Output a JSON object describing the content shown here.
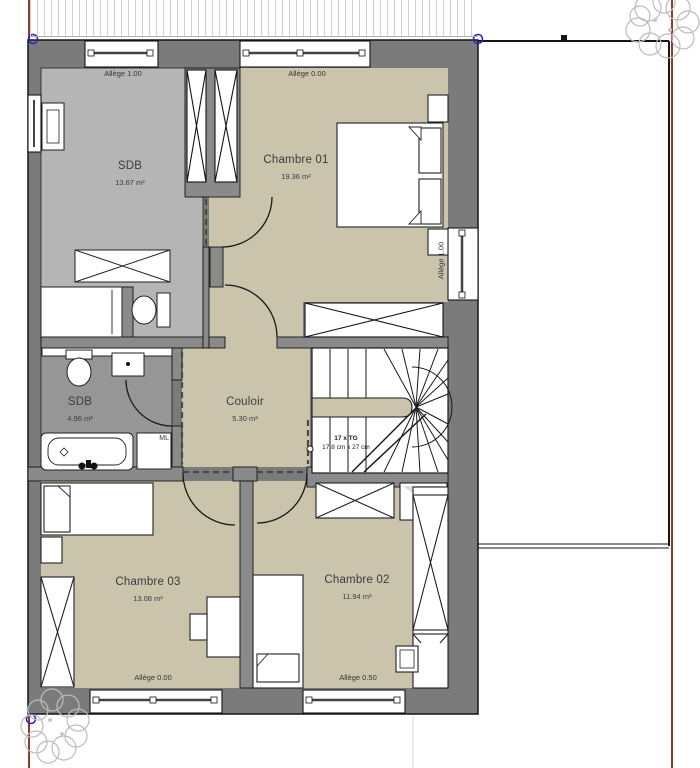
{
  "plan": {
    "rooms": [
      {
        "name": "SDB",
        "area": "13.67 m²"
      },
      {
        "name": "Chambre 01",
        "area": "19.36 m²"
      },
      {
        "name": "SDB",
        "area": "4.96 m²"
      },
      {
        "name": "Couloir",
        "area": "5.30 m²"
      },
      {
        "name": "Chambre 03",
        "area": "13.08 m²"
      },
      {
        "name": "Chambre 02",
        "area": "11.94 m²"
      }
    ],
    "sill_labels": {
      "top_left": "Allège 1.00",
      "top_right": "Allège 0.00",
      "right": "Allège 1.00",
      "bottom_left": "Allège 0.00",
      "bottom_right": "Allège 0.50"
    },
    "stairs": {
      "count_label": "17 x TG",
      "step_label": "17,8 cm x 27 cm"
    },
    "appliances": {
      "washing_machine": "ML"
    },
    "colors": {
      "exterior_wall": "#7b7b7b",
      "interior_wall": "#8a8a8a",
      "floor_bath_large": "#b5b5b5",
      "floor_bath_small": "#969696",
      "floor_rooms": "#cbc4ad",
      "boundary_line": "#8f3b2c",
      "corner_marker": "#2525cc"
    }
  }
}
